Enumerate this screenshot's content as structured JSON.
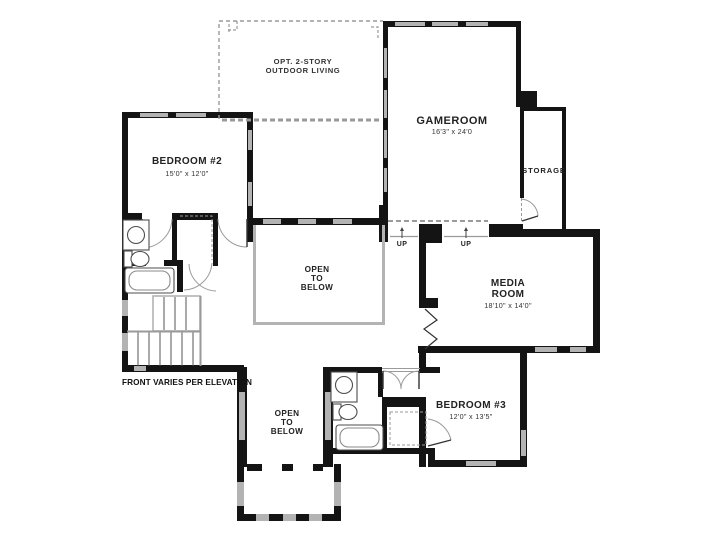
{
  "plan": {
    "note": "FRONT VARIES PER ELEVATION",
    "rooms": {
      "outdoor_living": {
        "line1": "OPT. 2-STORY",
        "line2": "OUTDOOR LIVING"
      },
      "gameroom": {
        "name": "GAMEROOM",
        "dims": "16'3\" x 24'0"
      },
      "storage": {
        "name": "STORAGE"
      },
      "bedroom2": {
        "name": "BEDROOM #2",
        "dims": "15'0\" x 12'0\""
      },
      "media_room": {
        "line1": "MEDIA",
        "line2": "ROOM",
        "dims": "18'10\" x 14'0\""
      },
      "bedroom3": {
        "name": "BEDROOM #3",
        "dims": "12'0\" x 13'5\""
      },
      "open_below_center": {
        "line1": "OPEN",
        "line2": "TO",
        "line3": "BELOW"
      },
      "open_below_front": {
        "line1": "OPEN",
        "line2": "TO",
        "line3": "BELOW"
      }
    },
    "stairs": {
      "up1": "UP",
      "up2": "UP"
    },
    "colors": {
      "wall": "#141414",
      "window_glass": "#b3b3b3",
      "dashed_line": "#9a9a9a",
      "fixture_line": "#4d4d4d"
    }
  }
}
